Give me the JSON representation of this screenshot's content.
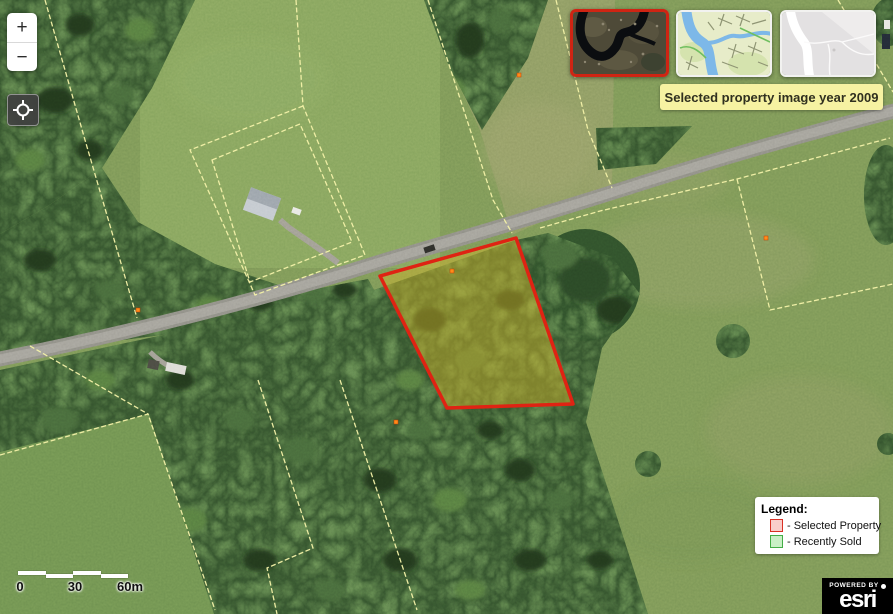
{
  "controls": {
    "zoom_in": "+",
    "zoom_out": "−",
    "locate_icon": "crosshair-icon"
  },
  "basemaps": {
    "selected_border": "#cf2413",
    "items": [
      {
        "name": "aerial-imagery-thumbnail",
        "selected": true
      },
      {
        "name": "street-map-thumbnail",
        "selected": false
      },
      {
        "name": "light-gray-map-thumbnail",
        "selected": false
      }
    ]
  },
  "tooltip": {
    "text": "Selected property image year 2009"
  },
  "legend": {
    "title": "Legend:",
    "items": [
      {
        "label": "- Selected Property",
        "swatch_fill": "#f9cdca",
        "swatch_border": "#d93025"
      },
      {
        "label": "- Recently Sold",
        "swatch_fill": "#c9f0c6",
        "swatch_border": "#43ad46"
      }
    ]
  },
  "scale_bar": {
    "ticks": [
      "0",
      "30",
      "60m"
    ]
  },
  "attribution": {
    "powered_by": "POWERED BY",
    "brand": "esri"
  },
  "map": {
    "selected_property": {
      "outline": "#df2313",
      "fill": "#d6b82a"
    },
    "parcel_line_color": "#f4f2a2"
  }
}
